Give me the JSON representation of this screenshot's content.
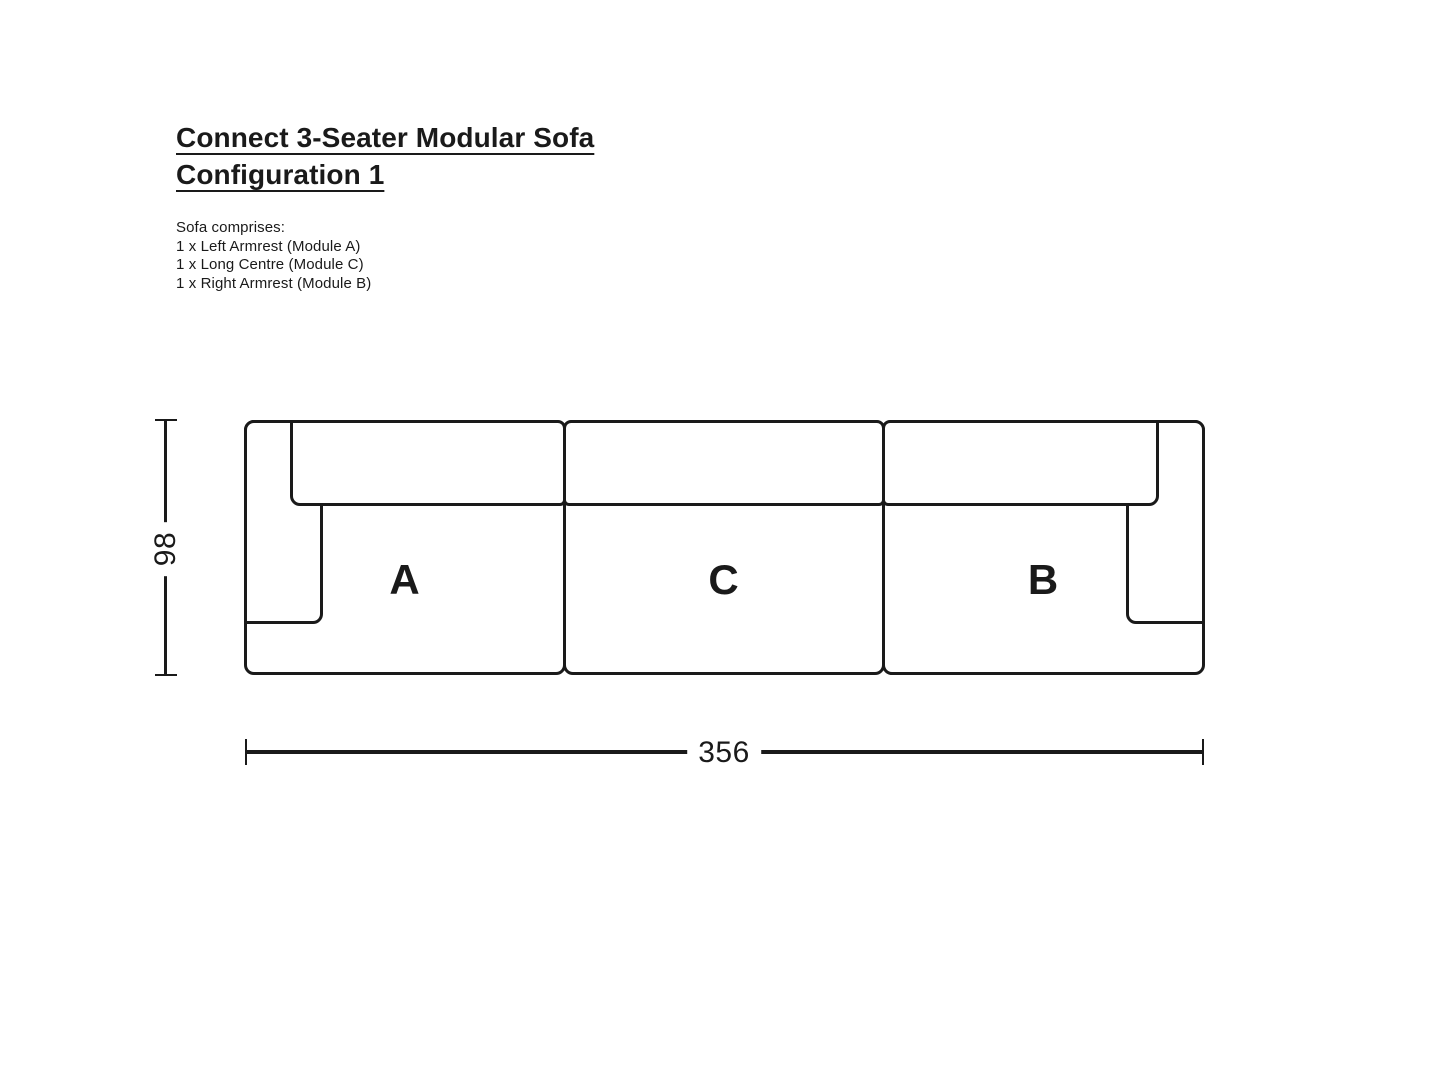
{
  "page": {
    "background": "#ffffff",
    "line_color": "#1a1a1a"
  },
  "header": {
    "title_line1": "Connect 3-Seater Modular Sofa",
    "title_line2": "Configuration 1"
  },
  "intro": {
    "heading": "Sofa comprises:",
    "items": [
      "1 x Left Armrest (Module A)",
      "1 x Long Centre (Module C)",
      "1 x Right Armrest (Module B)"
    ]
  },
  "diagram": {
    "modules": [
      {
        "label": "A"
      },
      {
        "label": "C"
      },
      {
        "label": "B"
      }
    ],
    "dimensions": {
      "depth": "98",
      "width": "356"
    }
  }
}
